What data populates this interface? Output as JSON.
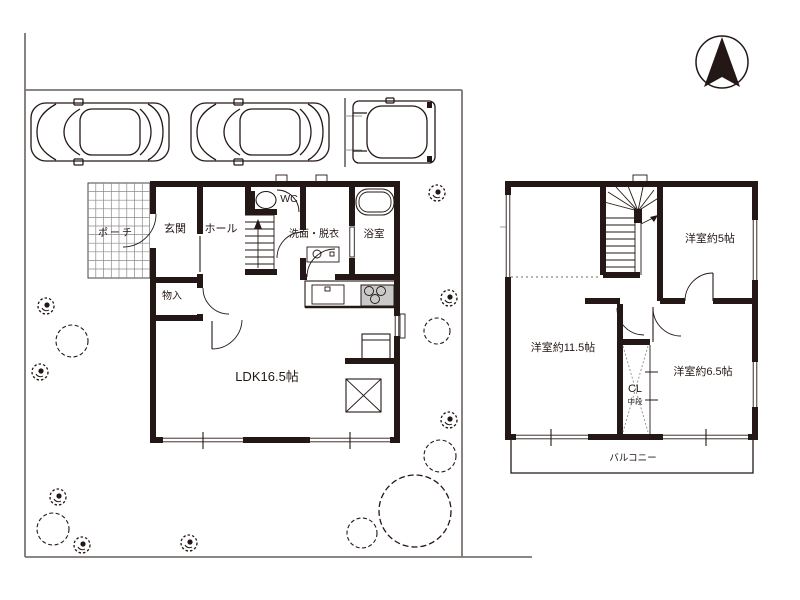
{
  "floor1": {
    "porch": "ポーチ",
    "entrance": "玄関",
    "hall": "ホール",
    "wc": "WC",
    "washroom": "洗面・脱衣",
    "bath": "浴室",
    "storage": "物入",
    "ldk": "LDK16.5帖"
  },
  "floor2": {
    "room_5": "洋室約5帖",
    "room_11_5": "洋室約11.5帖",
    "room_6_5": "洋室約6.5帖",
    "closet": "CL",
    "closet_note": "中段",
    "balcony": "バルコニー"
  },
  "colors": {
    "ink": "#231815",
    "site_boundary": "#7a7572",
    "stove_fill": "#c9c9c9",
    "background": "#ffffff"
  }
}
